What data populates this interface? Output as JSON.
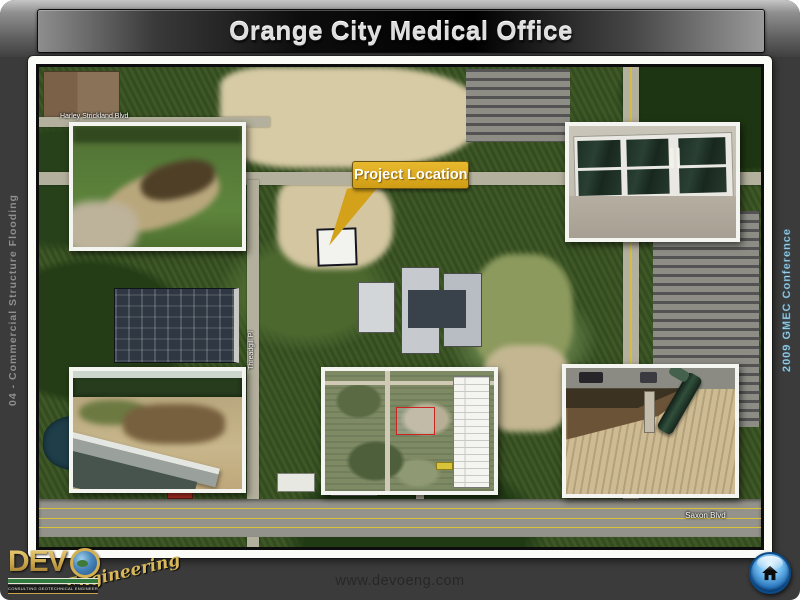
{
  "header": {
    "title": "Orange City Medical Office"
  },
  "sidebars": {
    "left": "04 - Commercial Structure Flooding",
    "right": "2009 GMEC Conference"
  },
  "map": {
    "callout_label": "Project Location",
    "street_labels": {
      "harley": "Harley Strickland Blvd",
      "threadgill": "Threadgill Pl",
      "saxon": "Saxon Blvd"
    },
    "insets": [
      {
        "id": "photo-eroded-grass-swale",
        "position": "top-left"
      },
      {
        "id": "photo-building-entry-doors",
        "position": "top-right"
      },
      {
        "id": "photo-eroded-canal-bank",
        "position": "bottom-left"
      },
      {
        "id": "aerial-site-plan",
        "position": "bottom-center"
      },
      {
        "id": "photo-washout-exposed-pipe",
        "position": "bottom-right"
      }
    ]
  },
  "footer": {
    "website": "www.devoeng.com"
  },
  "logo": {
    "prefix": "DEV",
    "full_name": "DEVO",
    "script": "Engineering",
    "tagline": "CONSULTING GEOTECHNICAL ENGINEERING"
  },
  "colors": {
    "slide_background": "#3b3b3b",
    "callout_gold": "#d9a620",
    "logo_gold": "#c9a44a",
    "home_button_blue": "#2d7cc4"
  }
}
